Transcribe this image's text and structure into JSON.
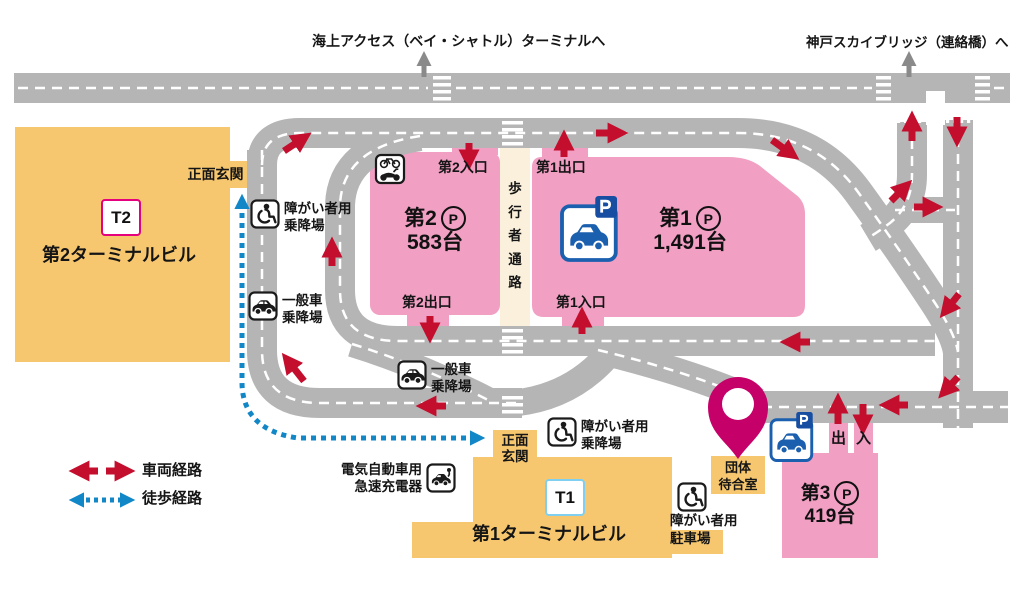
{
  "map_title_labels": {
    "sea_access": "海上アクセス（ベイ・シャトル）ターミナルへ",
    "sky_bridge": "神戸スカイブリッジ（連絡橋）へ"
  },
  "terminal2": {
    "code": "T2",
    "name": "第2ターミナルビル",
    "main_entrance": "正面玄関"
  },
  "terminal1": {
    "code": "T1",
    "name": "第1ターミナルビル",
    "main_entrance": "正面\n玄関"
  },
  "parking_lots": {
    "p1": {
      "name": "第1",
      "p_symbol": "P",
      "capacity": "1,491台",
      "exit": "第1出口",
      "entrance": "第1入口"
    },
    "p2": {
      "name": "第2",
      "p_symbol": "P",
      "capacity": "583台",
      "entrance": "第2入口",
      "exit": "第2出口"
    },
    "p3": {
      "name": "第3",
      "p_symbol": "P",
      "capacity": "419台",
      "exit": "出",
      "entrance": "入"
    }
  },
  "pedestrian_corridor": "歩\n行\n者\n通\n路",
  "facilities": {
    "t2_disabled_stop": "障がい者用\n乗降場",
    "t2_general_stop": "一般車\n乗降場",
    "mid_general_stop": "一般車\n乗降場",
    "t1_disabled_stop": "障がい者用\n乗降場",
    "ev_charger": "電気自動車用\n急速充電器",
    "group_waiting_room": "団体\n待合室",
    "disabled_parking": "障がい者用\n駐車場"
  },
  "legend": {
    "vehicle_route": "車両経路",
    "walking_route": "徒歩経路"
  },
  "colors": {
    "road": "#b5b5b6",
    "parking": "#f19fc3",
    "building": "#f6c76f",
    "walkway": "#faf0db",
    "vehicle_arrow": "#c40e2e",
    "walk_arrow": "#1187c8",
    "pin": "#c50068",
    "t2_accent": "#e5007e",
    "t1_accent": "#7fd0f0",
    "parking_sign_blue": "#1b5faf"
  }
}
